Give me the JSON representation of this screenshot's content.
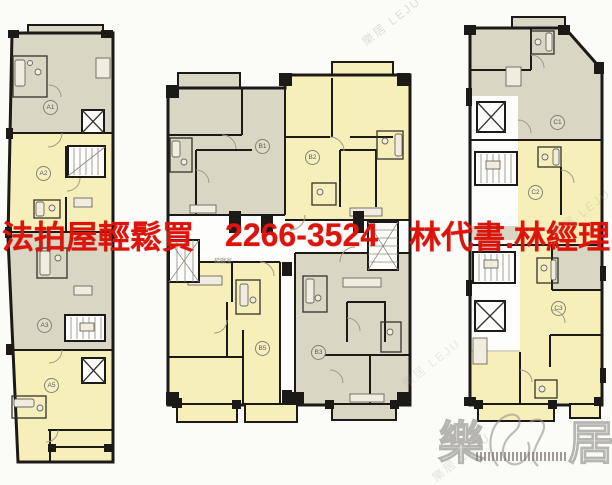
{
  "ad": {
    "prefix": "法拍屋輕鬆買",
    "phone": "2266-3524",
    "contacts": "林代書.林經理",
    "color": "#dc140c"
  },
  "plan": {
    "type": "apartment-floor-plan",
    "buildings": {
      "left": {
        "units": [
          "A1",
          "A2",
          "A3",
          "A5"
        ]
      },
      "middle": {
        "units": [
          "B1",
          "B2",
          "B5",
          "B3"
        ]
      },
      "right": {
        "units": [
          "C1",
          "C2",
          "C3"
        ]
      }
    },
    "labels": {
      "stair_hall": "梯廳室"
    },
    "colors": {
      "unit_green_gray": "#d9d6c3",
      "unit_yellow": "#f6efb9",
      "wall": "#1c1a17",
      "background": "#fbfbf8"
    }
  },
  "watermark": {
    "brand_char_left": "樂",
    "brand_char_right": "居",
    "diagonal_text": "樂居 LEJU"
  }
}
